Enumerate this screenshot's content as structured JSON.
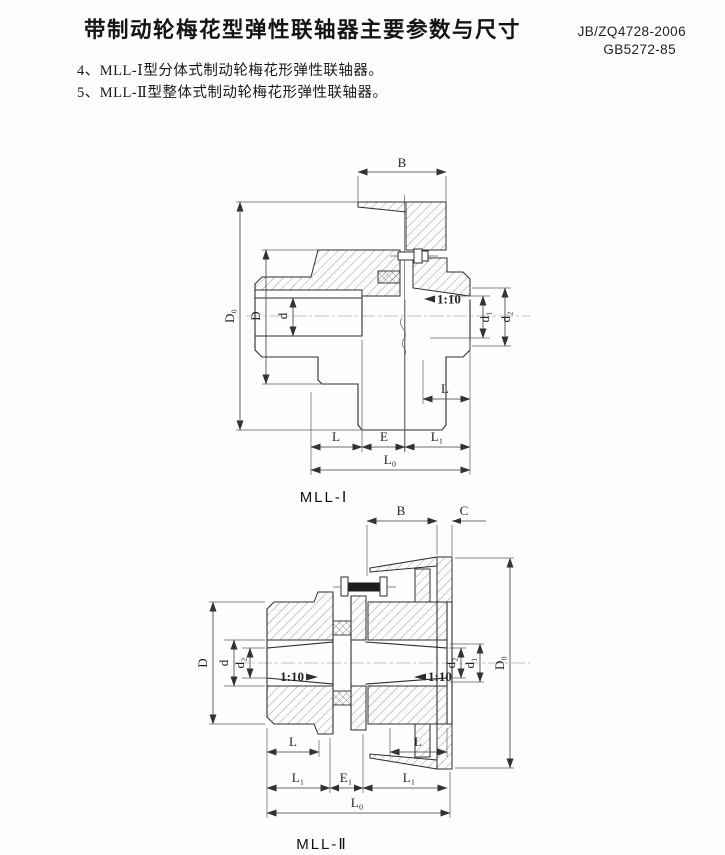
{
  "page": {
    "title": "带制动轮梅花型弹性联轴器主要参数与尺寸",
    "standard_line1": "JB/ZQ4728-2006",
    "standard_line2": "GB5272-85",
    "note4": "4、MLL-Ⅰ型分体式制动轮梅花形弹性联轴器。",
    "note5": "5、MLL-Ⅱ型整体式制动轮梅花形弹性联轴器。"
  },
  "fig1": {
    "caption": "MLL-Ⅰ",
    "dims": {
      "B": "B",
      "D0": "D₀",
      "D": "D",
      "d": "d",
      "taper": "1:10",
      "d1": "d₁",
      "d2": "d₂",
      "L_hub_right": "L",
      "L": "L",
      "E": "E",
      "L1": "L₁",
      "L0": "L₀"
    }
  },
  "fig2": {
    "caption": "MLL-Ⅱ",
    "dims": {
      "B": "B",
      "C": "C",
      "D0": "D₀",
      "D": "D",
      "d": "d",
      "d2_left": "d₂",
      "taper_left": "1:10",
      "taper_right": "1:10",
      "d2_right": "d₂",
      "d1": "d₁",
      "L_left": "L",
      "L_right": "L",
      "L1_left": "L₁",
      "E1": "E₁",
      "L1_right": "L₁",
      "L0": "L₀"
    }
  }
}
